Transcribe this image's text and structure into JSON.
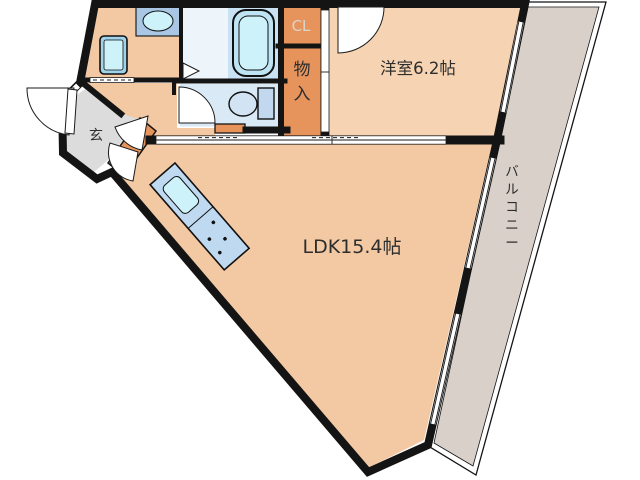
{
  "rooms": {
    "ldk": {
      "label": "LDK15.4帖"
    },
    "western": {
      "label": "洋室6.2帖"
    },
    "balcony": {
      "label": "バルコニー"
    },
    "entrance": {
      "label": "玄"
    },
    "closet": {
      "label": "CL"
    },
    "storage": {
      "label": "物入"
    }
  },
  "colors": {
    "floor": "#F3C9A3",
    "western_floor": "#F6D3B2",
    "storage_orange": "#E6945C",
    "entrance_gray": "#DCDCDC",
    "balcony_gray": "#D9D1C9",
    "wet_area_blue": "#D9E9F5",
    "bath_blue": "#C9E2F3",
    "bath_pale": "#EDF5FB",
    "fixture_blue": "#CDF2FA",
    "counter_blue": "#BFD9F0",
    "wall": "#141414"
  },
  "fixtures": {
    "bathtub": "bathtub-icon",
    "toilet": "toilet-icon",
    "washbasin": "washbasin-icon",
    "washing_machine_pan": "washing-machine-icon",
    "kitchen_counter": "kitchen-counter-icon"
  }
}
